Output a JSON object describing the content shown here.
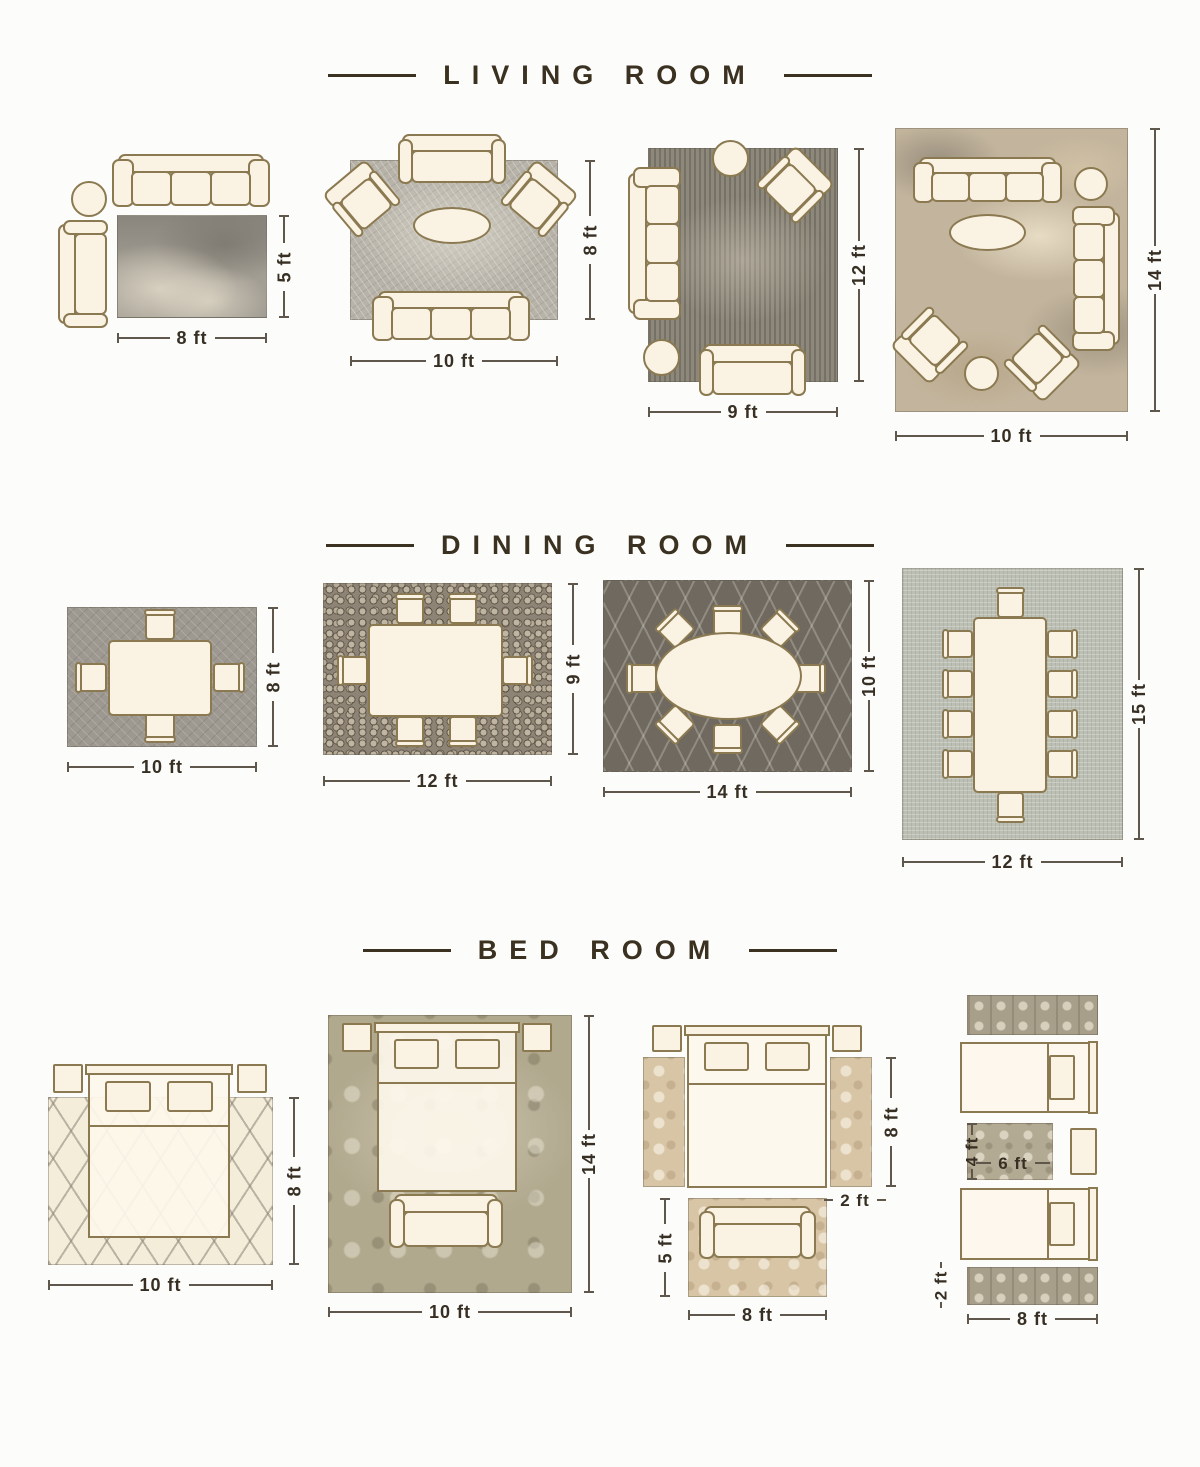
{
  "page": {
    "background": "#fcfcfa"
  },
  "colors": {
    "title": "#3b3121",
    "dimension_text": "#372f24",
    "furniture_outline": "#8b7a51",
    "furniture_fill": "#faf2e3"
  },
  "sections": [
    {
      "title": "LIVING ROOM",
      "layouts": [
        {
          "rug_width": "8 ft",
          "rug_height": "5 ft"
        },
        {
          "rug_width": "10 ft",
          "rug_height": "8 ft"
        },
        {
          "rug_width": "9 ft",
          "rug_height": "12 ft"
        },
        {
          "rug_width": "10 ft",
          "rug_height": "14 ft"
        }
      ]
    },
    {
      "title": "DINING ROOM",
      "layouts": [
        {
          "rug_width": "10 ft",
          "rug_height": "8 ft"
        },
        {
          "rug_width": "12 ft",
          "rug_height": "9 ft"
        },
        {
          "rug_width": "14 ft",
          "rug_height": "10 ft"
        },
        {
          "rug_width": "12 ft",
          "rug_height": "15 ft"
        }
      ]
    },
    {
      "title": "BED ROOM",
      "layouts": [
        {
          "rug_width": "10 ft",
          "rug_height": "8 ft"
        },
        {
          "rug_width": "10 ft",
          "rug_height": "14 ft"
        },
        {
          "runner_length": "8 ft",
          "runner_width": "2 ft",
          "foot_rug_height": "5 ft",
          "foot_rug_width": "8 ft"
        },
        {
          "middle_rug_height": "4 ft",
          "middle_rug_width": "6 ft",
          "runner_width": "2 ft",
          "runner_length": "8 ft"
        }
      ]
    }
  ]
}
